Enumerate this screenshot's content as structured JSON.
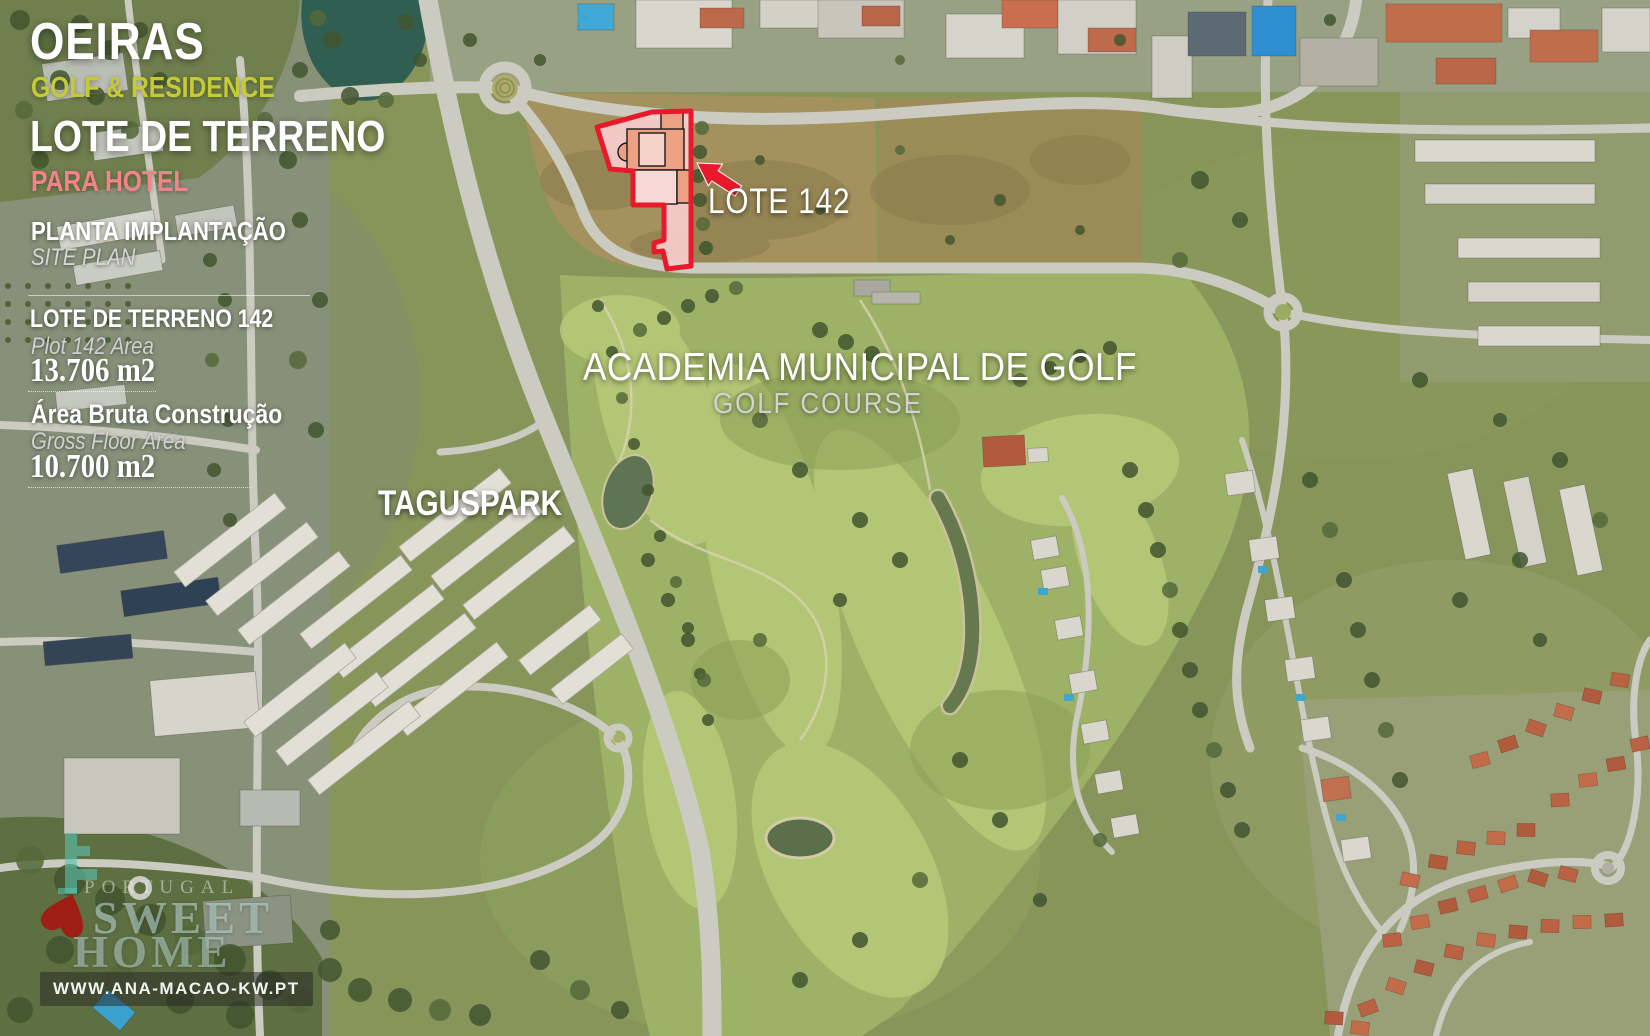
{
  "flyer": {
    "title": "OEIRAS",
    "subtitle": "GOLF & RESIDENCE",
    "heading": "LOTE DE TERRENO",
    "subheading": "PARA HOTEL",
    "section": {
      "title": "PLANTA IMPLANTAÇÃO",
      "subtitle": "SITE PLAN"
    },
    "plot_area": {
      "label": "LOTE DE TERRENO 142",
      "sublabel": "Plot 142 Area",
      "value": "13.706 m2"
    },
    "gross_area": {
      "label": "Área Bruta Construção",
      "sublabel": "Gross Floor Area",
      "value": "10.700 m2"
    }
  },
  "map": {
    "labels": {
      "plot_callout": "LOTE 142",
      "golf_title": "ACADEMIA MUNICIPAL DE GOLF",
      "golf_subtitle": "GOLF COURSE",
      "district": "TAGUSPARK"
    }
  },
  "watermark": {
    "brand_top": "PORTUGAL",
    "brand_main": "SWEET",
    "brand_bottom": "HOME",
    "website": "WWW.ANA-MACAO-KW.PT"
  },
  "colors": {
    "accent_red": "#e8192b",
    "plot_fill": "#f7cdcd",
    "building_fill": "#eda183",
    "subtitle_yellow": "#c6cb35",
    "subheading_pink": "#f2838b",
    "muted_text": "#d2d2d2",
    "watermark_teal": "#58c3b4"
  }
}
